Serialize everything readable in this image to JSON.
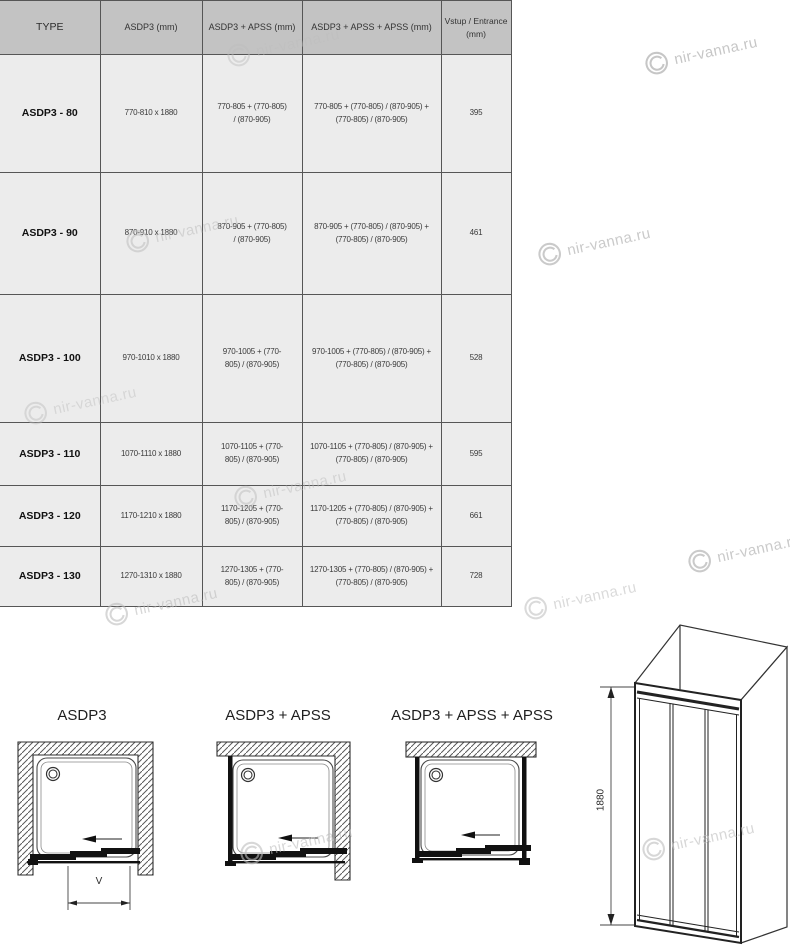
{
  "watermark": {
    "text": "nir-vanna.ru"
  },
  "table": {
    "columns": [
      "TYPE",
      "ASDP3 (mm)",
      "ASDP3 + APSS (mm)",
      "ASDP3 + APSS + APSS (mm)",
      "Vstup / Entrance (mm)"
    ],
    "rows": [
      {
        "cells": [
          "ASDP3 - 80",
          "770-810 x 1880",
          "770-805 + (770-805) / (870-905)",
          "770-805 + (770-805) / (870-905) + (770-805) / (870-905)",
          "395"
        ]
      },
      {
        "cells": [
          "ASDP3 - 90",
          "870-910 x 1880",
          "870-905 + (770-805) / (870-905)",
          "870-905 + (770-805) / (870-905) + (770-805) / (870-905)",
          "461"
        ]
      },
      {
        "cells": [
          "ASDP3 - 100",
          "970-1010 x 1880",
          "970-1005 + (770-805) / (870-905)",
          "970-1005 + (770-805) / (870-905) + (770-805) / (870-905)",
          "528"
        ]
      },
      {
        "cells": [
          "ASDP3 - 110",
          "1070-1110 x 1880",
          "1070-1105 + (770-805) / (870-905)",
          "1070-1105 + (770-805) / (870-905) + (770-805) / (870-905)",
          "595"
        ]
      },
      {
        "cells": [
          "ASDP3 - 120",
          "1170-1210 x 1880",
          "1170-1205 + (770-805) / (870-905)",
          "1170-1205 + (770-805) / (870-905) + (770-805) / (870-905)",
          "661"
        ]
      },
      {
        "cells": [
          "ASDP3 - 130",
          "1270-1310 x 1880",
          "1270-1305 + (770-805) / (870-905)",
          "1270-1305 + (770-805) / (870-905) + (770-805) / (870-905)",
          "728"
        ]
      }
    ]
  },
  "diagrams": {
    "plan1_title": "ASDP3",
    "plan2_title": "ASDP3 + APSS",
    "plan3_title": "ASDP3 + APSS + APSS",
    "entrance_dim_label": "V",
    "height_dim_label": "1880"
  }
}
